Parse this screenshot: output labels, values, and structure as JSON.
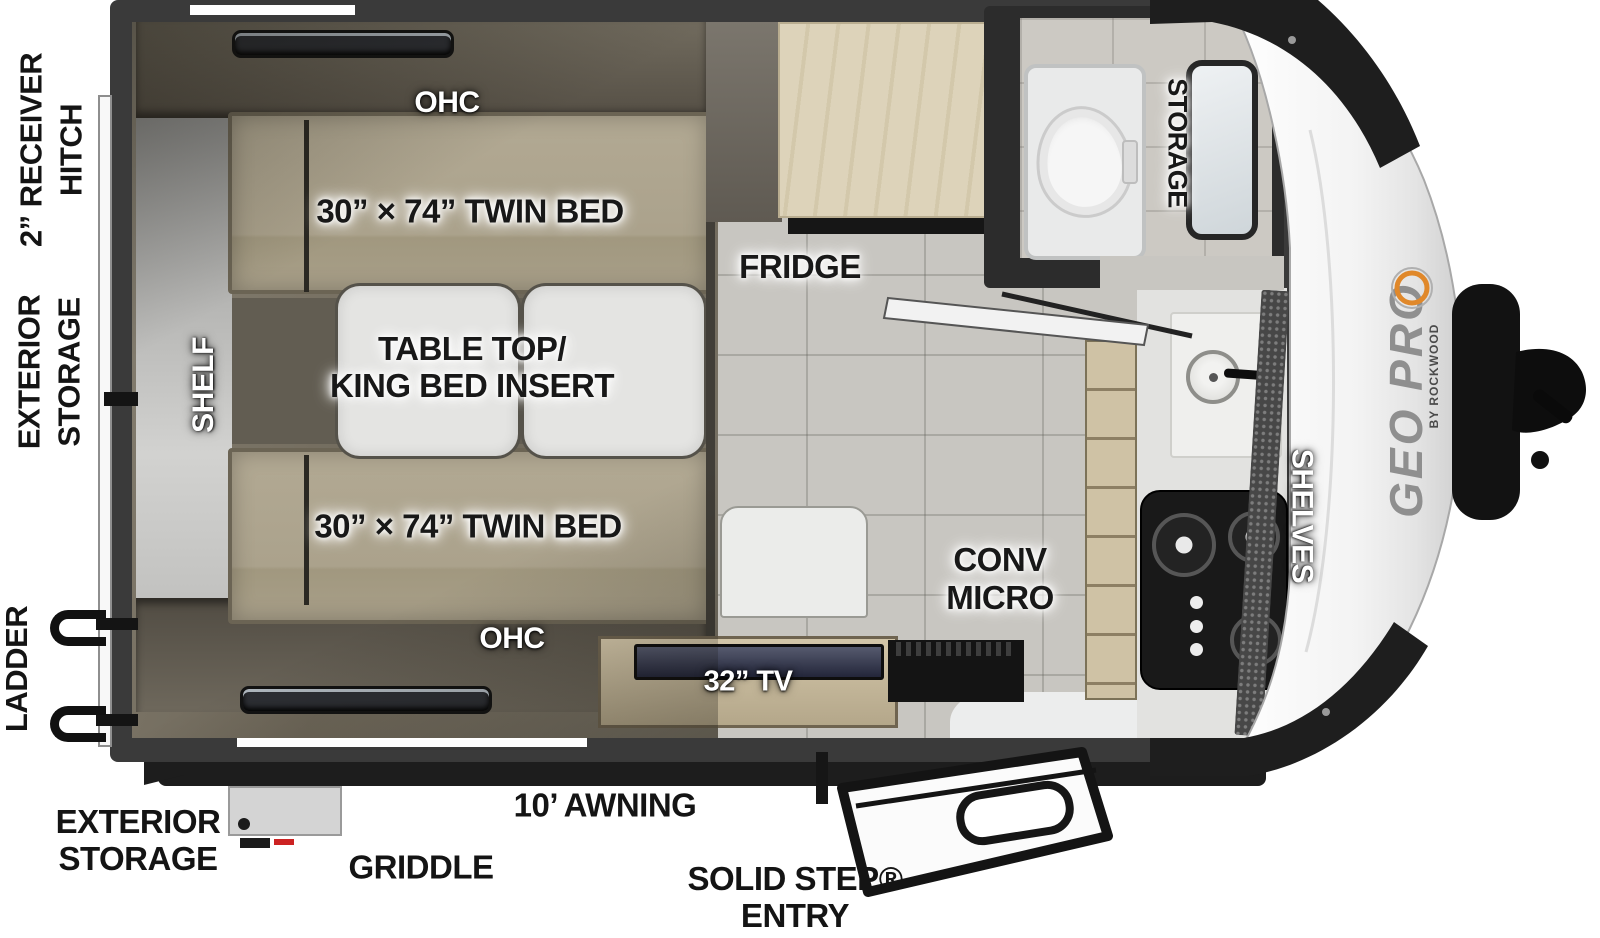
{
  "plan": {
    "side_labels": {
      "hitch_line1": "2” RECEIVER",
      "hitch_line2": "HITCH",
      "storage_line1": "EXTERIOR",
      "storage_line2": "STORAGE",
      "ladder": "LADDER"
    },
    "bottom_labels": {
      "storage_line1": "EXTERIOR",
      "storage_line2": "STORAGE",
      "griddle": "GRIDDLE",
      "awning": "10’ AWNING",
      "entry_line1": "SOLID STEP®",
      "entry_line2": "ENTRY"
    },
    "interior_labels": {
      "ohc_top": "OHC",
      "ohc_bottom": "OHC",
      "twin_bed_top": "30” × 74” TWIN BED",
      "twin_bed_bottom": "30” × 74” TWIN BED",
      "shelf": "SHELF",
      "table_line1": "TABLE TOP/",
      "table_line2": "KING BED INSERT",
      "fridge": "FRIDGE",
      "storage_front": "STORAGE",
      "conv_line1": "CONV",
      "conv_line2": "MICRO",
      "shelves": "SHELVES",
      "tv": "32” TV"
    },
    "branding": {
      "logo": "GEO PRO",
      "logo_sub": "BY ROCKWOOD"
    },
    "colors": {
      "wall": "#3a3a3a",
      "mattress": "#aba28c",
      "cabinet_wood": "#ddd3ba",
      "tile": "#c8c6c1",
      "logo_orange": "#e0882a",
      "cooktop": "#191919",
      "nose_white": "#f2f2f2"
    }
  }
}
